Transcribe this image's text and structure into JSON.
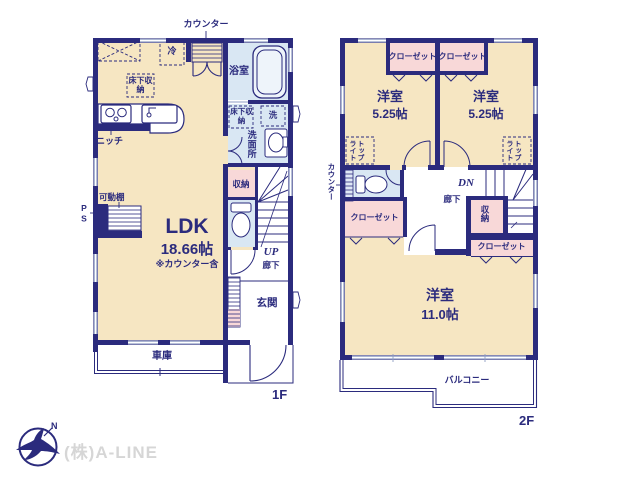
{
  "branding": {
    "company": "(株)A-LINE",
    "compass_label": "N"
  },
  "colors": {
    "wall": "#2b2b7d",
    "room_cream": "#f6e6c2",
    "room_blue": "#d9e7f3",
    "room_pink": "#f8d8d8",
    "window_line": "#8f9ec4",
    "logo_text": "#d6d6d6"
  },
  "floor1": {
    "label": "1F",
    "annotations": {
      "counter": "カウンター",
      "fridge": "冷",
      "underfloor_storage_kitchen": "床下収納",
      "niche": "ニッチ",
      "movable_shelf": "可動棚",
      "pipe_space": "PS",
      "underfloor_storage_wash": "床下収納",
      "washer": "洗"
    },
    "rooms": {
      "ldk": {
        "name": "LDK",
        "size": "18.66帖",
        "note": "※カウンター含"
      },
      "bathroom": "浴室",
      "washroom": "洗面所",
      "storage": "収納",
      "hallway": "廊下",
      "stairs_up": "UP",
      "entrance": "玄関",
      "garage": "車庫"
    }
  },
  "floor2": {
    "label": "2F",
    "annotations": {
      "counter": "カウンター",
      "toplight_left": "トップライト",
      "toplight_right": "トップライト"
    },
    "rooms": {
      "bedroom_small_left": {
        "name": "洋室",
        "size": "5.25帖"
      },
      "bedroom_small_right": {
        "name": "洋室",
        "size": "5.25帖"
      },
      "bedroom_large": {
        "name": "洋室",
        "size": "11.0帖"
      },
      "closet_top_left": "クローゼット",
      "closet_top_right": "クローゼット",
      "closet_mid_left": "クローゼット",
      "closet_mid_right": "クローゼット",
      "storage": "収納",
      "hallway": "廊下",
      "stairs_down": "DN",
      "balcony": "バルコニー"
    }
  }
}
